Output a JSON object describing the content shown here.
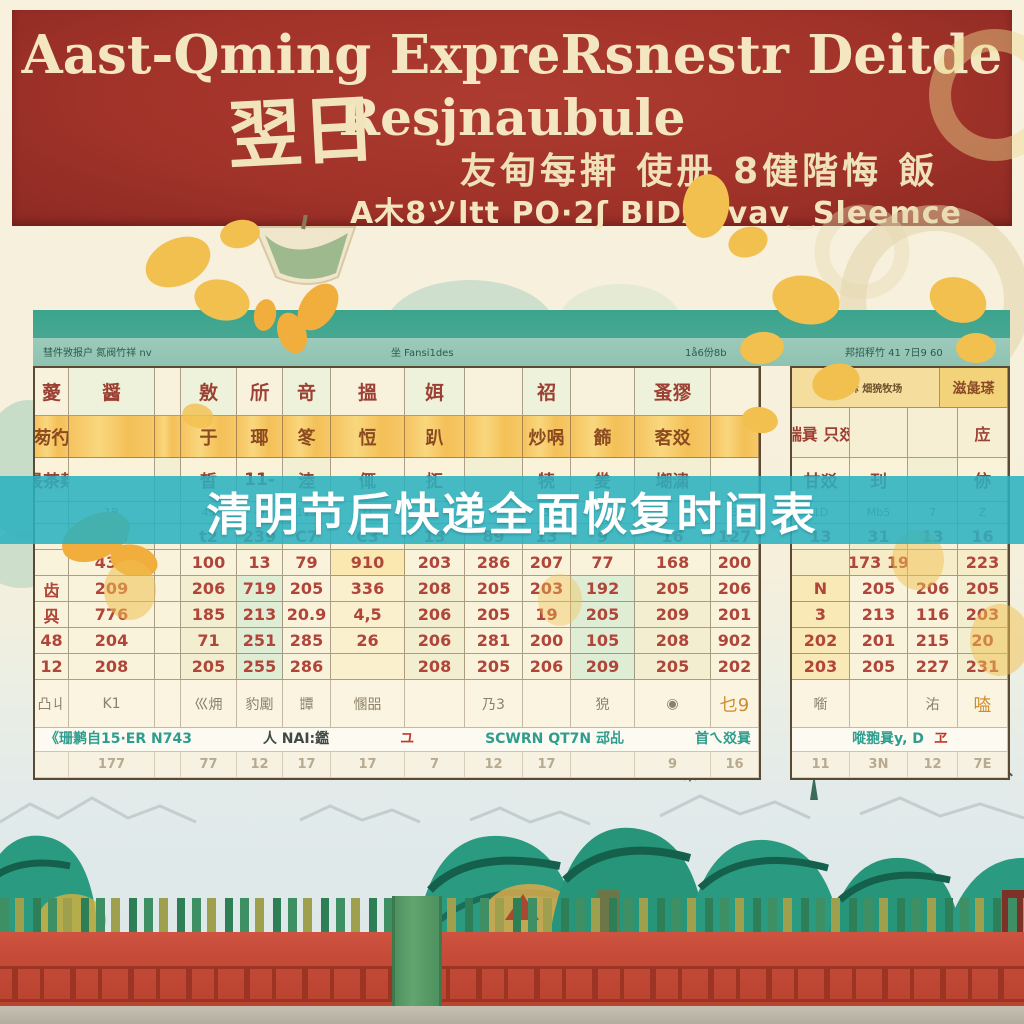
{
  "palette": {
    "banner_red": "#a2332a",
    "banner_text": "#f3e6c0",
    "band_teal": "#3ba48d",
    "overlay_teal": "#2bb1c0",
    "number_red": "#b0453a",
    "fence_red": "#c24936",
    "tree_green": "#2a9b80",
    "cream": "#f6efdc"
  },
  "banner": {
    "title_line1": "Aast-Qming ExpreRsnestr Deitde",
    "title_line2": "Resjnaubule",
    "stamp": "翌日",
    "cn_line": "友甸每搟 使册 8健階悔 飯",
    "sub_line": "A木8ツltt PO·2ʃ BIDAevav ͜ Sleemce"
  },
  "overlay": {
    "text": "清明节后快递全面恢复时间表"
  },
  "main_table": {
    "band_labels": [
      "彗件敩报户 氮阀竹祥 nv",
      "坐 Fansi1des",
      "1å6份8b",
      "邦招稃竹 41 7日9 60"
    ],
    "rows": [
      {
        "kind": "g1",
        "cells": [
          "薆",
          "醤",
          "",
          "敫",
          "斦",
          "竒",
          "搵",
          "㛅",
          "",
          "祒",
          "",
          "蚤㺒",
          ""
        ]
      },
      {
        "kind": "orange",
        "cells": [
          "茐彴",
          "",
          "",
          "于",
          "瑘",
          "笗",
          "㤱",
          "趴",
          "",
          "炒㖞",
          "籂",
          "㚚㸚",
          ""
        ]
      },
      {
        "kind": "g2",
        "cells": [
          "晸茶觌",
          "",
          "",
          "皙",
          "11-",
          "淕",
          "㑙",
          "㧟",
          "",
          "㸿",
          "夎",
          "㙟㴋",
          ""
        ]
      },
      {
        "kind": "small",
        "cells": [
          "",
          "1B",
          "",
          "45",
          "-9",
          "113",
          "O",
          "3",
          "",
          "3",
          "E",
          "",
          "3"
        ]
      },
      {
        "kind": "n0",
        "cells": [
          "",
          "638",
          "",
          "t2",
          "239",
          "C7",
          "C3",
          "13",
          "89",
          "13",
          "9",
          "16",
          "127"
        ]
      },
      {
        "kind": "numA",
        "cells": [
          "",
          "432",
          "",
          "100",
          "13",
          "79",
          "910",
          "203",
          "286",
          "207",
          "77",
          "168",
          "200"
        ]
      },
      {
        "kind": "num",
        "cells": [
          "齿",
          "209",
          "",
          "206",
          "719",
          "205",
          "336",
          "208",
          "205",
          "203",
          "192",
          "205",
          "206"
        ]
      },
      {
        "kind": "num",
        "cells": [
          "㒷",
          "776",
          "",
          "185",
          "213",
          "20.9",
          "4,5",
          "206",
          "205",
          "19",
          "205",
          "209",
          "201"
        ]
      },
      {
        "kind": "num",
        "cells": [
          "48",
          "204",
          "",
          "71",
          "251",
          "285",
          "26",
          "206",
          "281",
          "200",
          "105",
          "208",
          "902"
        ]
      },
      {
        "kind": "num",
        "cells": [
          "12",
          "208",
          "",
          "205",
          "255",
          "286",
          "",
          "208",
          "205",
          "206",
          "209",
          "205",
          "202"
        ]
      },
      {
        "kind": "foot",
        "cells": [
          "凸丩",
          "K1",
          "",
          "巛㶲",
          "豹㔉",
          "㽑",
          "㥵㗊",
          "",
          "乃3",
          "",
          "㹸",
          "◉",
          "乜9"
        ]
      },
      {
        "kind": "strip",
        "cells": [
          ""
        ]
      },
      {
        "kind": "faint",
        "cells": [
          "",
          "177",
          "",
          "77",
          "12",
          "17",
          "17",
          "7",
          "12",
          "17",
          "",
          "9",
          "16"
        ]
      }
    ]
  },
  "right_table": {
    "rows": [
      {
        "kind": "band",
        "cells": [
          "傅汉稣 畑㹸牧场",
          "滋彘瑹"
        ]
      },
      {
        "kind": "g1r",
        "cells": [
          "㟨㠱 只㸚",
          "",
          "",
          "㡴"
        ]
      },
      {
        "kind": "g2",
        "cells": [
          "甘㸚",
          "㺫",
          "",
          "㑊"
        ]
      },
      {
        "kind": "small",
        "cells": [
          "1D",
          "Mb5",
          "7",
          "Z"
        ]
      },
      {
        "kind": "n0",
        "cells": [
          "13",
          "31",
          "13",
          "16"
        ]
      },
      {
        "kind": "numA",
        "cells": [
          "",
          "173 19",
          "",
          "223"
        ]
      },
      {
        "kind": "num",
        "cells": [
          "N",
          "205",
          "206",
          "205"
        ]
      },
      {
        "kind": "num",
        "cells": [
          "3",
          "213",
          "116",
          "203"
        ]
      },
      {
        "kind": "num",
        "cells": [
          "202",
          "201",
          "215",
          "20"
        ]
      },
      {
        "kind": "num",
        "cells": [
          "203",
          "205",
          "227",
          "231"
        ]
      },
      {
        "kind": "foot",
        "cells": [
          "㘅",
          "",
          "㳓",
          "㗐"
        ]
      },
      {
        "kind": "strip",
        "cells": [
          ""
        ]
      },
      {
        "kind": "faint",
        "cells": [
          "11",
          "3N",
          "12",
          "7E"
        ]
      }
    ]
  },
  "strips": {
    "main": [
      {
        "text": "《珊鹣自15·ER N743",
        "color": "teal"
      },
      {
        "text": "人 NAI:鑑",
        "color": "dark"
      },
      {
        "text": "ユ",
        "color": "red"
      },
      {
        "text": "SCWRN QT7N 䢵乩",
        "color": "teal"
      },
      {
        "text": "首ㄟ㸚㠱",
        "color": "teal"
      }
    ],
    "right": [
      {
        "text": "㗰䎂㠱y, D",
        "color": "teal"
      },
      {
        "text": "ヱ",
        "color": "red"
      }
    ]
  }
}
